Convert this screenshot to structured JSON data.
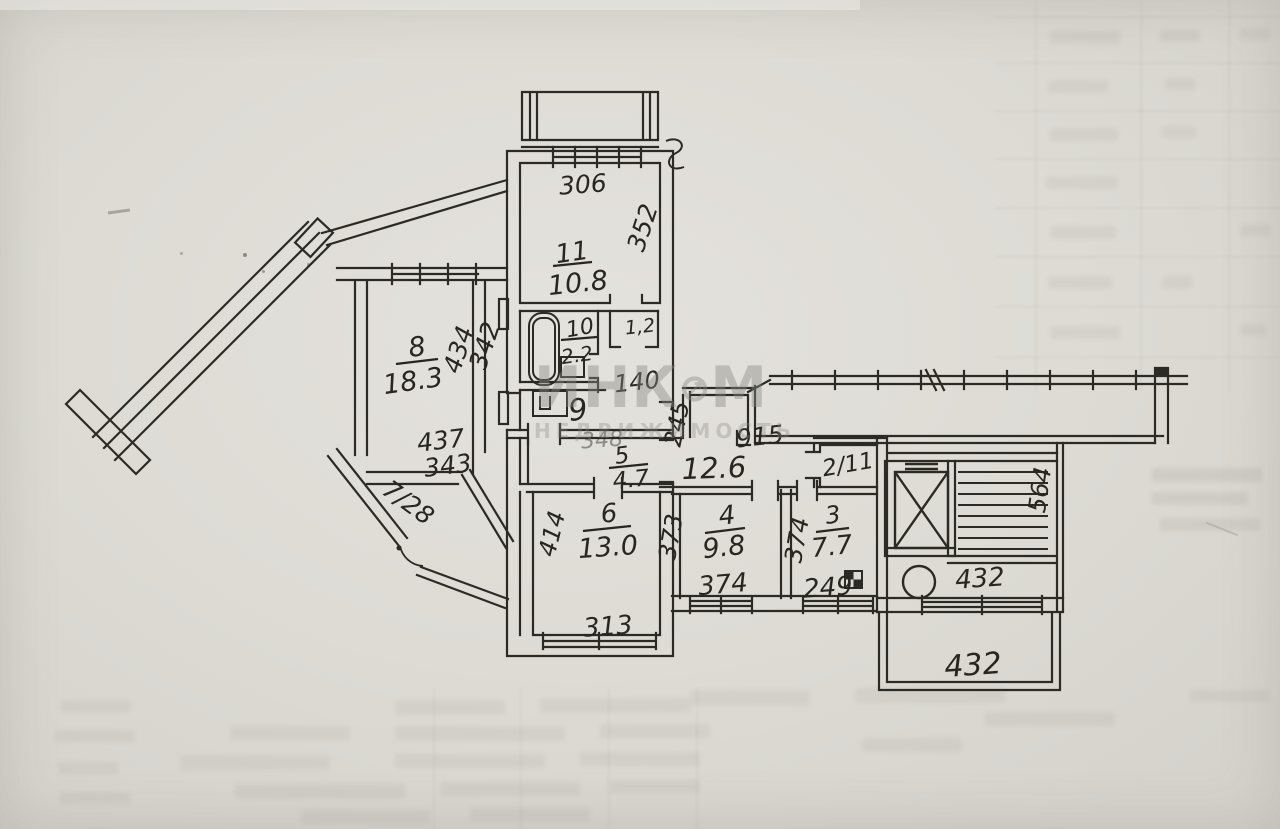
{
  "watermark": {
    "part1": "ИНК",
    "part2": "М",
    "subtitle": "НЕДВИЖИМОСТЬ"
  },
  "plan": {
    "rooms": {
      "room11": {
        "number": "11",
        "area": "10.8"
      },
      "room10": {
        "number": "10",
        "area": "2.2"
      },
      "wc": {
        "area": "1,2"
      },
      "room9": {
        "number": "9"
      },
      "room8": {
        "number": "8",
        "area": "18.3"
      },
      "balcony7": {
        "label": "7/28"
      },
      "room6": {
        "number": "6",
        "area": "13.0"
      },
      "room5": {
        "number": "5",
        "area": "4.7"
      },
      "corridor": {
        "area": "12.6"
      },
      "room4": {
        "number": "4",
        "area": "9.8"
      },
      "room3": {
        "number": "3",
        "area": "7.7"
      },
      "room2": {
        "label": "2/11"
      }
    },
    "dimensions": {
      "balcony_top": "306",
      "room11_side": "352",
      "room8_side_a": "434",
      "room8_side_b": "342",
      "room8_bottom_a": "437",
      "room8_bottom_b": "343",
      "hall": "140",
      "corridor_side": "245",
      "gallery": "915",
      "corridor_top": "348",
      "room6_side": "414",
      "room6_bottom": "313",
      "room4_side": "373",
      "room4_bottom": "374",
      "room3_side": "374",
      "room3_bottom": "249",
      "lobby": "432",
      "balcony_bottom": "432",
      "stairs_side": "564"
    }
  }
}
